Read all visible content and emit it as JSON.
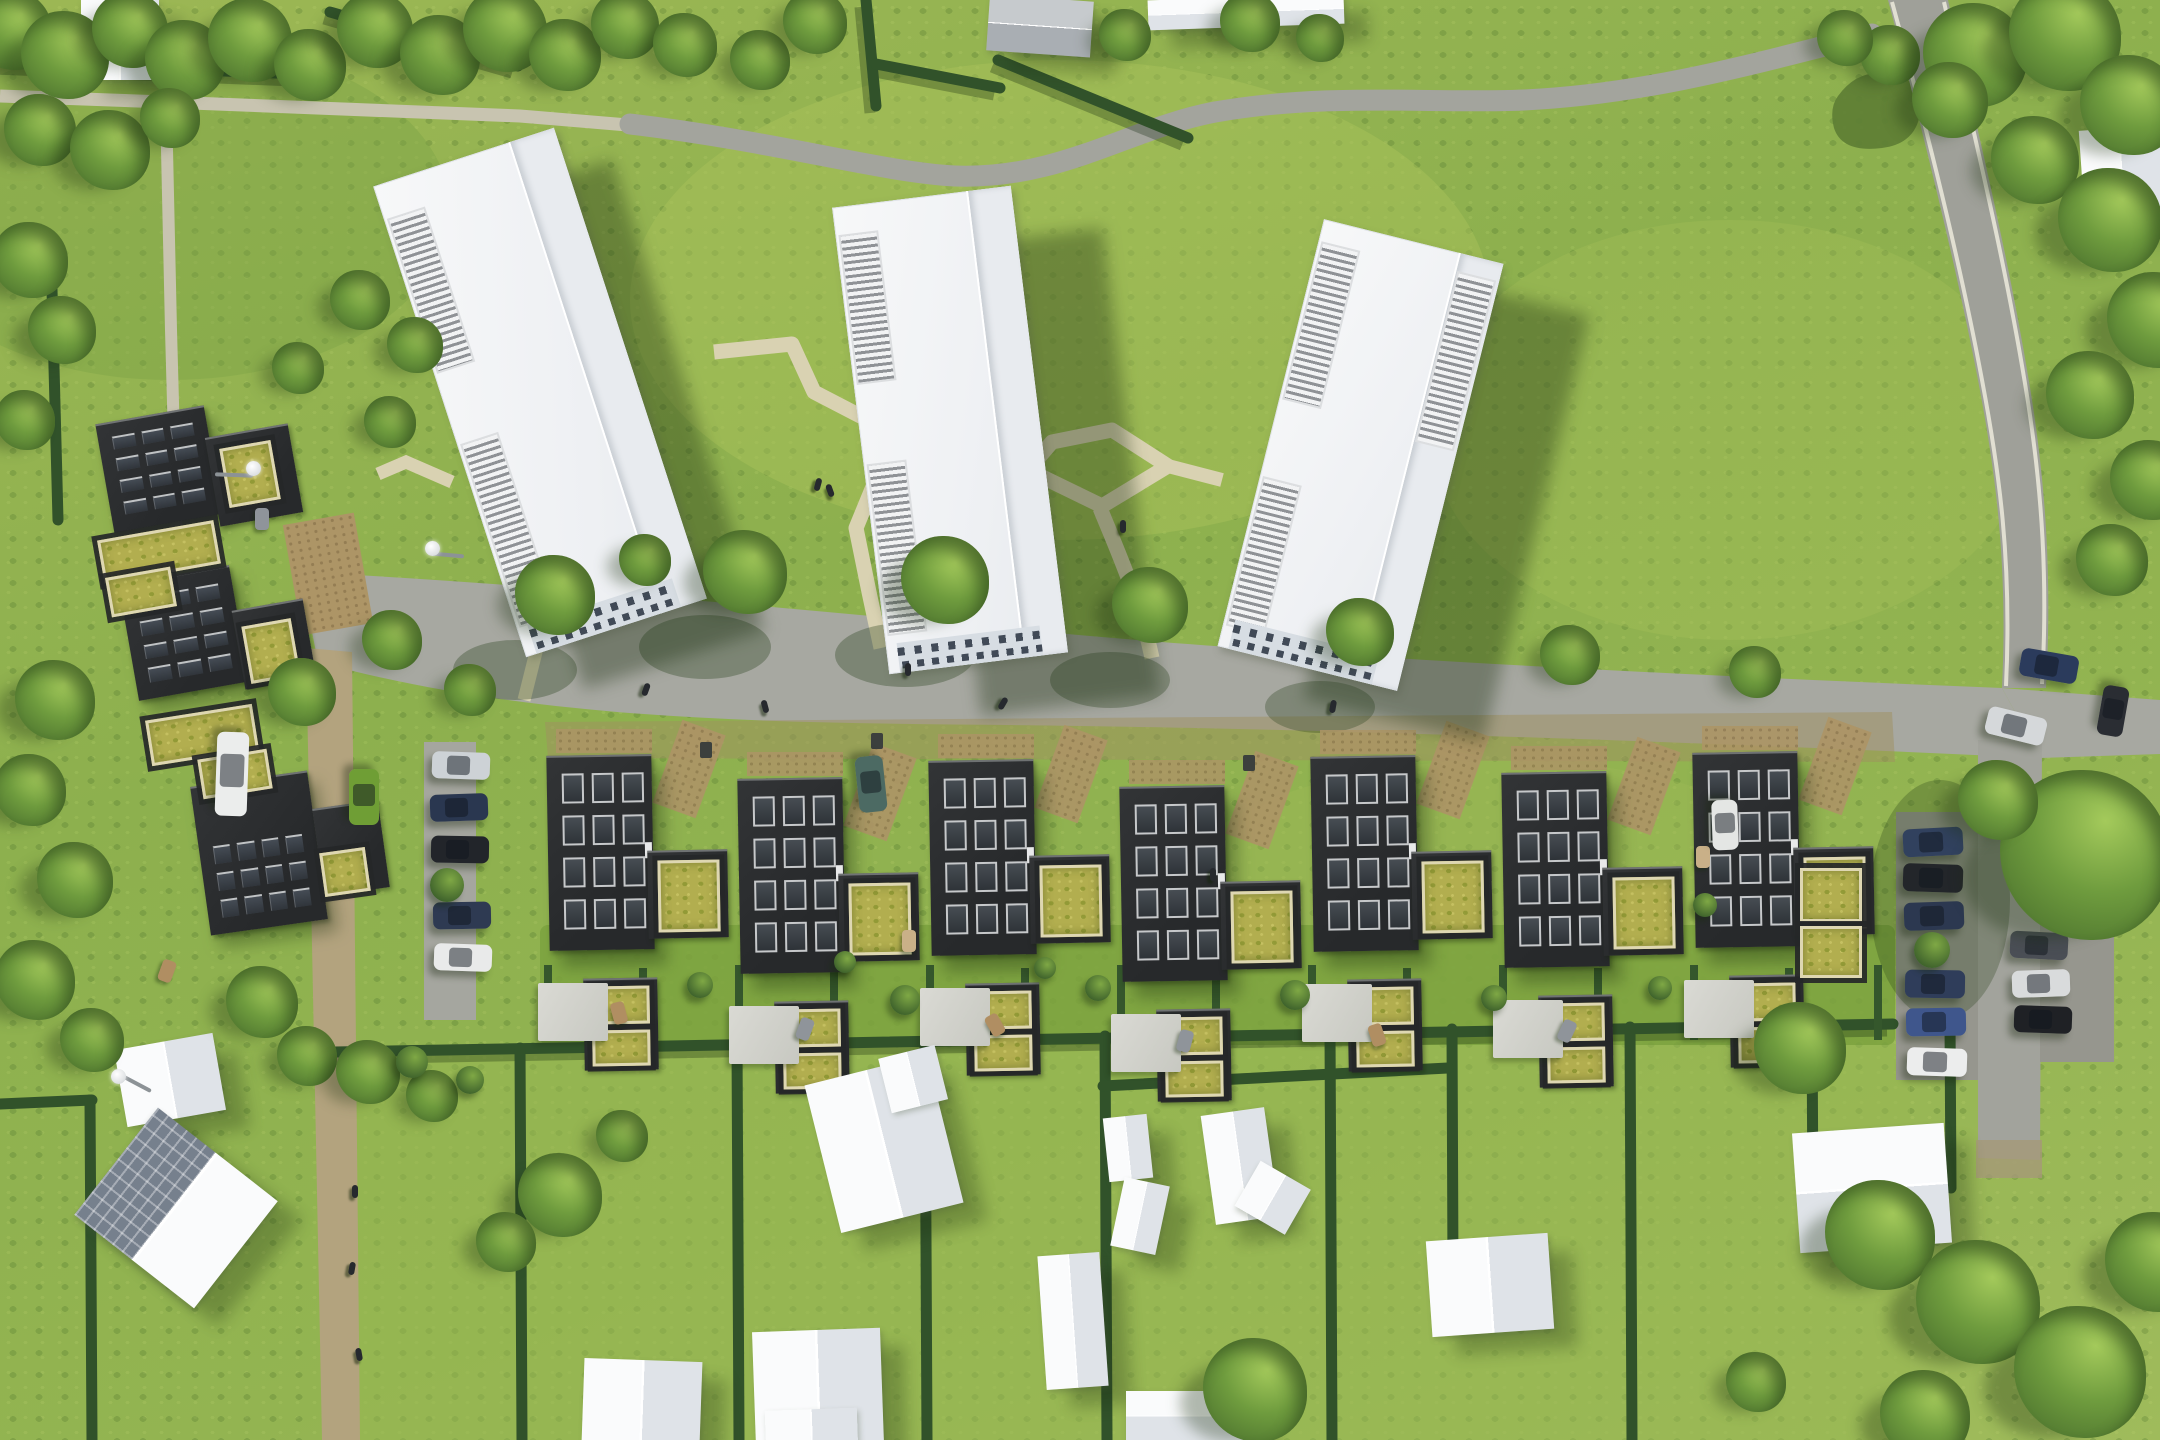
{
  "meta": {
    "description": "Aerial drone rendering of a green residential development: three white apartment towers on a meadow, a row of charcoal townhouses with sedum green roofs, solar-roof courtyard houses, curving roads with parked cars and hedged suburban garden plots with white gabled houses",
    "style": "photorealistic architectural visualization, top-down view, sunny daylight"
  },
  "palette": {
    "grass": "#8fb04e",
    "grass_light": "#aac35c",
    "grass_dark": "#7ba345",
    "road": "#a7a8a1",
    "road_minor": "#9fa099",
    "footpath": "#c8c4b0",
    "garden_path": "#d9d2b2",
    "lane": "#b3a37e",
    "gravel": "#ad9566",
    "hedge": "#31522a",
    "tree_dark": "#44692a",
    "tree_light": "#a4ca5b",
    "white_roof": "#f4f5f6",
    "roof_shade": "#e7eaee",
    "facade": "#d7dde3",
    "dark_roof": "#2c2e30",
    "skylight": "#3a3f44",
    "frame": "#c6c8ca",
    "sedum": "#b2ae4f",
    "sedum_frame": "#ded7b2",
    "shadow": "rgba(24,44,13,0.36)"
  },
  "scene": {
    "towers": [
      {
        "cx": 540,
        "cy": 392,
        "w": 190,
        "h": 495,
        "rot": -18,
        "shadow": [
          58,
          32
        ],
        "louvers": [
          {
            "side": "left",
            "from": 0.07,
            "to": 0.4
          },
          {
            "side": "left",
            "from": 0.55,
            "to": 0.94
          }
        ]
      },
      {
        "cx": 950,
        "cy": 430,
        "w": 180,
        "h": 470,
        "rot": -7,
        "shadow": [
          92,
          42
        ],
        "louvers": [
          {
            "side": "left",
            "from": 0.06,
            "to": 0.38
          },
          {
            "side": "left",
            "from": 0.55,
            "to": 0.92
          }
        ]
      },
      {
        "cx": 1360,
        "cy": 455,
        "w": 185,
        "h": 440,
        "rot": 14,
        "shadow": [
          86,
          52
        ],
        "louvers": [
          {
            "side": "left",
            "from": 0.05,
            "to": 0.42
          },
          {
            "side": "right",
            "from": 0.04,
            "to": 0.44
          },
          {
            "side": "left",
            "from": 0.6,
            "to": 0.95
          }
        ]
      }
    ],
    "townhouse_units": [
      {
        "x": 548,
        "y": 755
      },
      {
        "x": 739,
        "y": 778
      },
      {
        "x": 930,
        "y": 760
      },
      {
        "x": 1121,
        "y": 786
      },
      {
        "x": 1312,
        "y": 756
      },
      {
        "x": 1503,
        "y": 772
      },
      {
        "x": 1694,
        "y": 752
      }
    ],
    "unit_spec": {
      "bw": 105,
      "bh": 195,
      "sky_rows": 4,
      "sky_cols": 3
    },
    "solar_blocks": [
      {
        "x": 104,
        "y": 414,
        "w": 110,
        "h": 110,
        "rot": -10,
        "rows": 4,
        "cols": 3,
        "top": 0.12
      },
      {
        "x": 128,
        "y": 574,
        "w": 112,
        "h": 118,
        "rot": -10,
        "rows": 4,
        "cols": 3,
        "top": 0.12
      },
      {
        "x": 200,
        "y": 778,
        "w": 118,
        "h": 150,
        "rot": -8,
        "rows": 3,
        "cols": 4,
        "top": 0.4
      }
    ],
    "dark_wings": [
      {
        "x": 212,
        "y": 430,
        "w": 84,
        "h": 90,
        "rot": -10
      },
      {
        "x": 238,
        "y": 604,
        "w": 72,
        "h": 80,
        "rot": -10
      },
      {
        "x": 318,
        "y": 804,
        "w": 66,
        "h": 88,
        "rot": -8
      }
    ],
    "sedum_patches": [
      {
        "x": 100,
        "y": 530,
        "w": 118,
        "h": 44,
        "rot": -10
      },
      {
        "x": 108,
        "y": 572,
        "w": 66,
        "h": 40,
        "rot": -10
      },
      {
        "x": 148,
        "y": 712,
        "w": 108,
        "h": 46,
        "rot": -9
      },
      {
        "x": 200,
        "y": 754,
        "w": 70,
        "h": 40,
        "rot": -9
      },
      {
        "x": 224,
        "y": 444,
        "w": 52,
        "h": 60,
        "rot": -10
      },
      {
        "x": 246,
        "y": 622,
        "w": 50,
        "h": 58,
        "rot": -10
      },
      {
        "x": 322,
        "y": 850,
        "w": 46,
        "h": 44,
        "rot": -8
      },
      {
        "x": 1800,
        "y": 868,
        "w": 62,
        "h": 54,
        "rot": 0
      },
      {
        "x": 1800,
        "y": 926,
        "w": 62,
        "h": 52,
        "rot": 0
      }
    ],
    "gravel_patches": [
      {
        "x": 292,
        "y": 518,
        "w": 72,
        "h": 112,
        "rot": -10
      }
    ],
    "houses": [
      {
        "cx": 120,
        "cy": 40,
        "w": 78,
        "h": 80,
        "rot": 0,
        "ridge": "v"
      },
      {
        "cx": 16,
        "cy": 28,
        "w": 34,
        "h": 44,
        "rot": 0,
        "ridge": "h"
      },
      {
        "cx": 1040,
        "cy": 26,
        "w": 104,
        "h": 56,
        "rot": 4,
        "ridge": "h",
        "tone": "gray"
      },
      {
        "cx": 1246,
        "cy": 12,
        "w": 196,
        "h": 30,
        "rot": -2,
        "ridge": "h"
      },
      {
        "cx": 2122,
        "cy": 176,
        "w": 80,
        "h": 96,
        "rot": -4,
        "ridge": "v"
      },
      {
        "cx": 170,
        "cy": 1080,
        "w": 100,
        "h": 78,
        "rot": -10,
        "ridge": "v"
      },
      {
        "cx": 176,
        "cy": 1208,
        "w": 152,
        "h": 136,
        "rot": 38,
        "ridge": "v",
        "solar": true
      },
      {
        "cx": 884,
        "cy": 1144,
        "w": 126,
        "h": 152,
        "rot": -14,
        "ridge": "v",
        "wing": {
          "dx": 44,
          "dy": -56,
          "w": 58,
          "h": 56,
          "rot": -14
        }
      },
      {
        "cx": 1073,
        "cy": 1321,
        "w": 62,
        "h": 134,
        "rot": -4,
        "ridge": "v"
      },
      {
        "cx": 1128,
        "cy": 1148,
        "w": 44,
        "h": 64,
        "rot": -6,
        "ridge": "v"
      },
      {
        "cx": 1140,
        "cy": 1216,
        "w": 46,
        "h": 70,
        "rot": 12,
        "ridge": "v"
      },
      {
        "cx": 1240,
        "cy": 1166,
        "w": 64,
        "h": 110,
        "rot": -8,
        "ridge": "v",
        "wing": {
          "dx": 28,
          "dy": 36,
          "w": 58,
          "h": 52,
          "rot": 30
        }
      },
      {
        "cx": 1188,
        "cy": 1416,
        "w": 124,
        "h": 50,
        "rot": 0,
        "ridge": "h"
      },
      {
        "cx": 642,
        "cy": 1402,
        "w": 118,
        "h": 84,
        "rot": 2,
        "ridge": "v"
      },
      {
        "cx": 818,
        "cy": 1388,
        "w": 128,
        "h": 116,
        "rot": -2,
        "ridge": "v",
        "wing": {
          "dx": -8,
          "dy": 46,
          "w": 92,
          "h": 50,
          "rot": -2
        }
      },
      {
        "cx": 1490,
        "cy": 1285,
        "w": 122,
        "h": 96,
        "rot": -4,
        "ridge": "v"
      },
      {
        "cx": 1872,
        "cy": 1188,
        "w": 152,
        "h": 120,
        "rot": -4,
        "ridge": "h"
      }
    ],
    "trees": [
      [
        12,
        30,
        40
      ],
      [
        65,
        55,
        44
      ],
      [
        130,
        30,
        38
      ],
      [
        185,
        60,
        40
      ],
      [
        250,
        40,
        42
      ],
      [
        310,
        65,
        36
      ],
      [
        375,
        30,
        38
      ],
      [
        440,
        55,
        40
      ],
      [
        505,
        30,
        42
      ],
      [
        565,
        55,
        36
      ],
      [
        625,
        25,
        34
      ],
      [
        685,
        45,
        32
      ],
      [
        40,
        130,
        36
      ],
      [
        110,
        150,
        40
      ],
      [
        170,
        118,
        30
      ],
      [
        760,
        60,
        30
      ],
      [
        815,
        22,
        32
      ],
      [
        1125,
        35,
        26
      ],
      [
        1250,
        22,
        30
      ],
      [
        1320,
        38,
        24
      ],
      [
        1890,
        55,
        30
      ],
      [
        1975,
        55,
        52
      ],
      [
        2065,
        35,
        56
      ],
      [
        2130,
        105,
        50
      ],
      [
        2035,
        160,
        44
      ],
      [
        2110,
        220,
        52
      ],
      [
        2155,
        320,
        48
      ],
      [
        2090,
        395,
        44
      ],
      [
        2150,
        480,
        40
      ],
      [
        2112,
        560,
        36
      ],
      [
        1950,
        100,
        38
      ],
      [
        1845,
        38,
        28
      ],
      [
        30,
        260,
        38
      ],
      [
        62,
        330,
        34
      ],
      [
        25,
        420,
        30
      ],
      [
        55,
        700,
        40
      ],
      [
        30,
        790,
        36
      ],
      [
        75,
        880,
        38
      ],
      [
        35,
        980,
        40
      ],
      [
        92,
        1040,
        32
      ],
      [
        360,
        300,
        30
      ],
      [
        415,
        345,
        28
      ],
      [
        298,
        368,
        26
      ],
      [
        392,
        640,
        30
      ],
      [
        302,
        692,
        34
      ],
      [
        262,
        1002,
        36
      ],
      [
        307,
        1056,
        30
      ],
      [
        368,
        1072,
        32
      ],
      [
        432,
        1096,
        26
      ],
      [
        390,
        422,
        26
      ],
      [
        555,
        595,
        40
      ],
      [
        745,
        572,
        42
      ],
      [
        945,
        580,
        44
      ],
      [
        1150,
        605,
        38
      ],
      [
        1360,
        632,
        34
      ],
      [
        1570,
        655,
        30
      ],
      [
        1755,
        672,
        26
      ],
      [
        470,
        690,
        26
      ],
      [
        645,
        560,
        26
      ],
      [
        2085,
        855,
        85
      ],
      [
        1998,
        800,
        40
      ],
      [
        1800,
        1048,
        46
      ],
      [
        1880,
        1235,
        55
      ],
      [
        1978,
        1302,
        62
      ],
      [
        2080,
        1372,
        66
      ],
      [
        2155,
        1262,
        50
      ],
      [
        1925,
        1415,
        45
      ],
      [
        1756,
        1382,
        30
      ],
      [
        560,
        1195,
        42
      ],
      [
        506,
        1242,
        30
      ],
      [
        622,
        1136,
        26
      ],
      [
        1255,
        1390,
        52
      ]
    ],
    "bushes": [
      [
        447,
        885,
        17
      ],
      [
        1932,
        950,
        18
      ],
      [
        700,
        985,
        13
      ],
      [
        905,
        1000,
        15
      ],
      [
        1098,
        988,
        13
      ],
      [
        1295,
        995,
        15
      ],
      [
        1494,
        998,
        13
      ],
      [
        1660,
        988,
        12
      ],
      [
        845,
        962,
        11
      ],
      [
        1045,
        968,
        11
      ],
      [
        412,
        1062,
        16
      ],
      [
        470,
        1080,
        14
      ],
      [
        1705,
        905,
        12
      ]
    ],
    "cars": [
      [
        432,
        752,
        58,
        27,
        2,
        "#cdd2d6"
      ],
      [
        430,
        794,
        58,
        27,
        -2,
        "#2a3750"
      ],
      [
        431,
        836,
        58,
        27,
        1,
        "#22252a"
      ],
      [
        433,
        902,
        58,
        27,
        -1,
        "#2e3a52"
      ],
      [
        434,
        944,
        58,
        27,
        2,
        "#e9eaea"
      ],
      [
        190,
        758,
        84,
        32,
        92,
        "#ebedec"
      ],
      [
        336,
        782,
        56,
        30,
        90,
        "#6f9e35"
      ],
      [
        843,
        770,
        56,
        28,
        84,
        "#4c6a63"
      ],
      [
        1700,
        812,
        50,
        26,
        88,
        "#e4e6e4"
      ],
      [
        1903,
        828,
        60,
        28,
        -3,
        "#31415e"
      ],
      [
        1903,
        864,
        60,
        28,
        2,
        "#23262a"
      ],
      [
        1904,
        902,
        60,
        28,
        -2,
        "#2c3850"
      ],
      [
        1905,
        970,
        60,
        28,
        1,
        "#2f3d5a"
      ],
      [
        1906,
        1008,
        60,
        28,
        -1,
        "#3f568c"
      ],
      [
        1907,
        1048,
        60,
        28,
        2,
        "#eceded"
      ],
      [
        2010,
        932,
        58,
        27,
        3,
        "#4a4e55"
      ],
      [
        2012,
        970,
        58,
        27,
        -2,
        "#d9dbdc"
      ],
      [
        2014,
        1006,
        58,
        27,
        2,
        "#1f2125"
      ],
      [
        2020,
        652,
        58,
        28,
        10,
        "#2b3b5c"
      ],
      [
        1986,
        712,
        60,
        28,
        14,
        "#d5d8da"
      ],
      [
        2088,
        698,
        50,
        26,
        100,
        "#2a2d33"
      ]
    ],
    "people": [
      [
        643,
        683,
        20
      ],
      [
        762,
        700,
        -15
      ],
      [
        905,
        663,
        0
      ],
      [
        1000,
        697,
        30
      ],
      [
        1330,
        700,
        10
      ],
      [
        1120,
        520,
        0
      ],
      [
        815,
        478,
        15
      ],
      [
        827,
        484,
        -20
      ],
      [
        352,
        1185,
        0
      ],
      [
        349,
        1262,
        10
      ],
      [
        356,
        1348,
        -10
      ],
      [
        1210,
        868,
        0
      ]
    ],
    "lamps": [
      {
        "x": 118,
        "y": 1076,
        "arm": 35,
        "rot": 28
      },
      {
        "x": 432,
        "y": 548,
        "arm": 32,
        "rot": 5
      },
      {
        "x": 253,
        "y": 468,
        "arm": -38,
        "rot": 2
      }
    ],
    "bins": [
      [
        700,
        742
      ],
      [
        1243,
        755
      ],
      [
        871,
        733
      ]
    ],
    "furniture": [
      [
        612,
        1002,
        -15,
        "#b08e62"
      ],
      [
        798,
        1018,
        20,
        "#8f949a"
      ],
      [
        988,
        1014,
        -30,
        "#b08e62"
      ],
      [
        1178,
        1030,
        15,
        "#8f949a"
      ],
      [
        1370,
        1024,
        -18,
        "#b08e62"
      ],
      [
        1560,
        1020,
        25,
        "#8f949a"
      ],
      [
        902,
        930,
        0,
        "#c9b088"
      ],
      [
        1696,
        846,
        0,
        "#c9b088"
      ],
      [
        255,
        508,
        0,
        "#8f949a"
      ],
      [
        160,
        960,
        20,
        "#b08e62"
      ]
    ]
  }
}
